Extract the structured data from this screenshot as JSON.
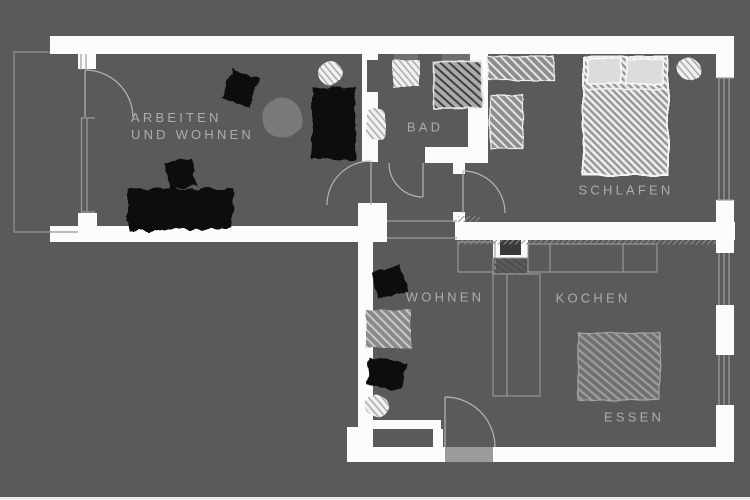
{
  "title": "Apartment floor plan",
  "rooms": {
    "arbeiten_wohnen": {
      "label": "ARBEITEN\nUND WOHNEN"
    },
    "bad": {
      "label": "BAD"
    },
    "schlafen": {
      "label": "SCHLAFEN"
    },
    "wohnen": {
      "label": "WOHNEN"
    },
    "kochen": {
      "label": "KOCHEN"
    },
    "essen": {
      "label": "ESSEN"
    }
  },
  "colors": {
    "background": "#5a5a5a",
    "wall": "#fbfbfb",
    "label_text": "#acacac",
    "thin_line": "#9c9c9c",
    "door_arc": "#b5b5b5",
    "furniture_black": "#0d0d0d",
    "furniture_gray": "#7a7a7a",
    "furniture_white": "#f1f1f1",
    "door_threshold": "#9a9a9a"
  },
  "furniture": {
    "arbeiten_wohnen": [
      "chair",
      "round-table",
      "bookshelf",
      "desk",
      "desk-chair",
      "plant"
    ],
    "bad": [
      "sink",
      "toilet",
      "washing-machine"
    ],
    "schlafen": [
      "wardrobe",
      "dresser",
      "double-bed",
      "plant"
    ],
    "wohnen": [
      "chair",
      "chair",
      "side-table",
      "plant"
    ],
    "kochen": [
      "kitchen-counter",
      "chimney-block"
    ],
    "essen": [
      "dining-table"
    ]
  }
}
